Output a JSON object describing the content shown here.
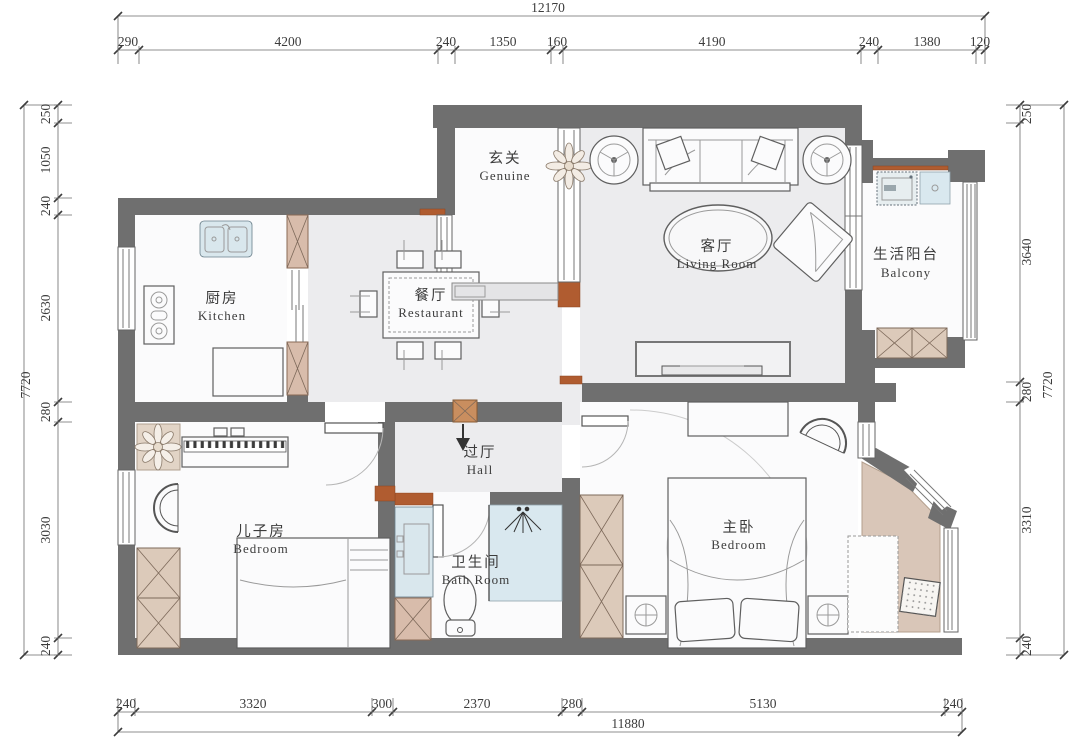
{
  "rooms": {
    "entry": {
      "zh": "玄关",
      "en": "Genuine"
    },
    "living": {
      "zh": "客厅",
      "en": "Living Room"
    },
    "balcony": {
      "zh": "生活阳台",
      "en": "Balcony"
    },
    "kitchen": {
      "zh": "厨房",
      "en": "Kitchen"
    },
    "dining": {
      "zh": "餐厅",
      "en": "Restaurant"
    },
    "hall": {
      "zh": "过厅",
      "en": "Hall"
    },
    "kid": {
      "zh": "儿子房",
      "en": "Bedroom"
    },
    "bath": {
      "zh": "卫生间",
      "en": "Bath Room"
    },
    "master": {
      "zh": "主卧",
      "en": "Bedroom"
    }
  },
  "dims": {
    "top_total": "12170",
    "top": [
      "290",
      "4200",
      "240",
      "1350",
      "160",
      "4190",
      "240",
      "1380",
      "120"
    ],
    "left_total": "7720",
    "left": [
      "250",
      "1050",
      "240",
      "2630",
      "280",
      "3030",
      "240"
    ],
    "right_total": "7720",
    "right": [
      "250",
      "3640",
      "280",
      "3310",
      "240"
    ],
    "bottom_total": "11880",
    "bottom": [
      "240",
      "3320",
      "300",
      "2370",
      "280",
      "5130",
      "240"
    ]
  },
  "colors": {
    "wall": "#6f6f6f",
    "accent_orange": "#b05c30",
    "cabinet_beige": "#dccaba",
    "water_blue": "#d9e7ed",
    "floor_gray": "#ececee"
  }
}
